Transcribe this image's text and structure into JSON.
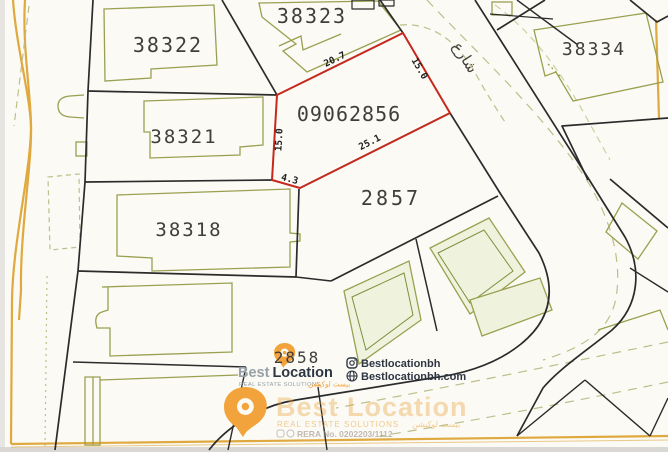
{
  "colors": {
    "paper": "#fbfaf5",
    "boundary_black": "#2b2b2b",
    "building_olive": "#9aa050",
    "dash_olive": "#bcbf8a",
    "building_fill": "#eff3dd",
    "highlight_red": "#c5281c",
    "survey_orange": "#dfa93f",
    "label_dark": "#3f3e3a",
    "brand_orange": "#f2a33c",
    "brand_navy": "#2d3643",
    "brand_gray": "#98a0a8"
  },
  "plot_labels": {
    "p38322": "38322",
    "p38323": "38323",
    "p38334": "38334",
    "p38321": "38321",
    "p38318": "38318",
    "p2857": "2857",
    "p2858": "2858",
    "highlight": "09062856"
  },
  "dimensions": {
    "top": "20.7",
    "right": "15.0",
    "bottom": "25.1",
    "corner": "4.3",
    "left": "15.0"
  },
  "street": {
    "label_ar": "شارع"
  },
  "logo": {
    "brand_first": "Best",
    "brand_second": "Location",
    "tagline_en": "REAL ESTATE SOLUTIONS",
    "tagline_ar": "بيست لوكيشن",
    "instagram": "Bestlocationbh",
    "website": "Bestlocationbh.com"
  },
  "watermark": {
    "brand": "Best Location",
    "tagline_en": "REAL ESTATE SOLUTIONS",
    "tagline_ar": "بيست لوكيشن",
    "rera": "RERA No. 0202203/1112"
  }
}
